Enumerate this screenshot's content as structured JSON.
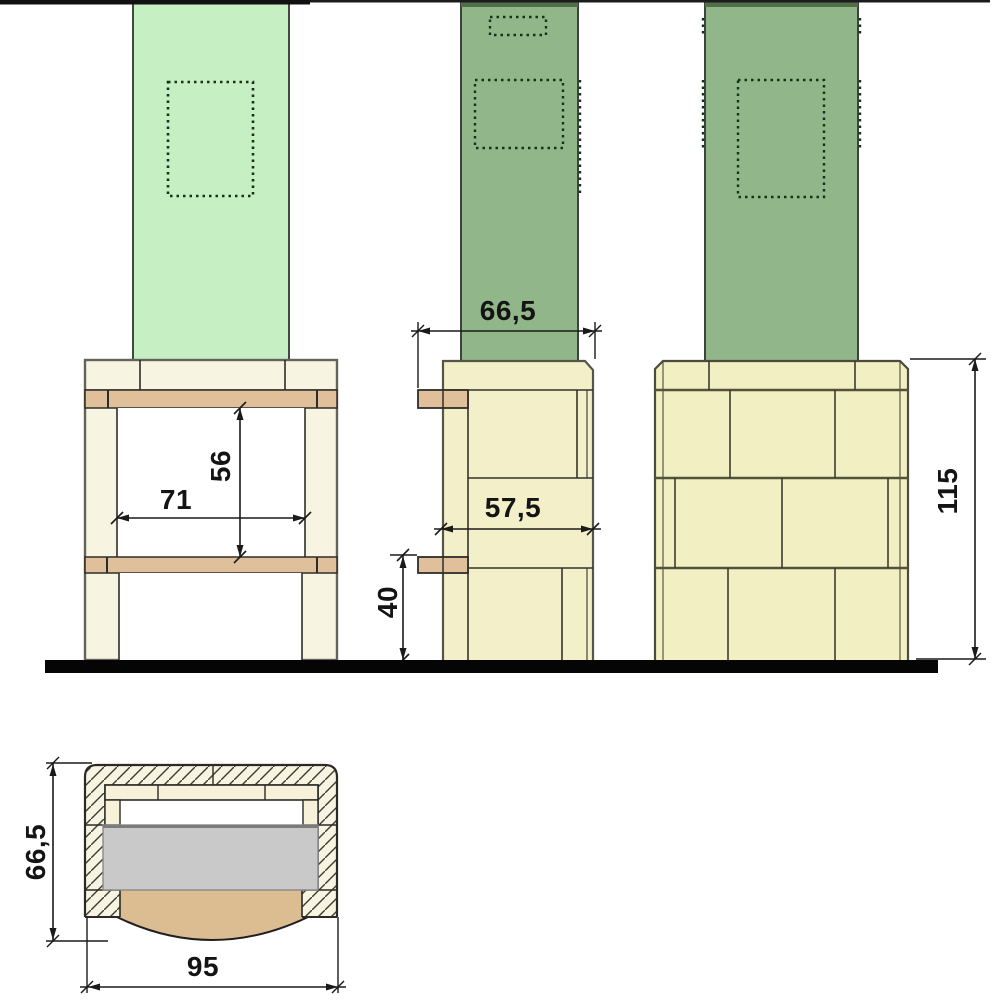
{
  "views": {
    "front": {
      "dims": {
        "opening_width": "71",
        "opening_height": "56"
      }
    },
    "side": {
      "dims": {
        "overall_depth_top": "66,5",
        "body_depth": "57,5",
        "lower_height": "40"
      }
    },
    "rear": {
      "dims": {
        "overall_height": "115"
      }
    },
    "plan": {
      "dims": {
        "overall_depth": "66,5",
        "overall_width": "95"
      }
    }
  },
  "palette": {
    "chimney_light_green": "#c6efc3",
    "chimney_sage_green": "#90b68a",
    "chimney_cap_dark": "#506e48",
    "block_cream": "#f8f4e2",
    "brick_yellow": "#f2efc2",
    "tan_band": "#dfc09a",
    "hearth_tan": "#dcbd92",
    "slab_gray": "#c9c9c9",
    "ground_black": "#050505",
    "line_dark": "#2d2d28"
  }
}
